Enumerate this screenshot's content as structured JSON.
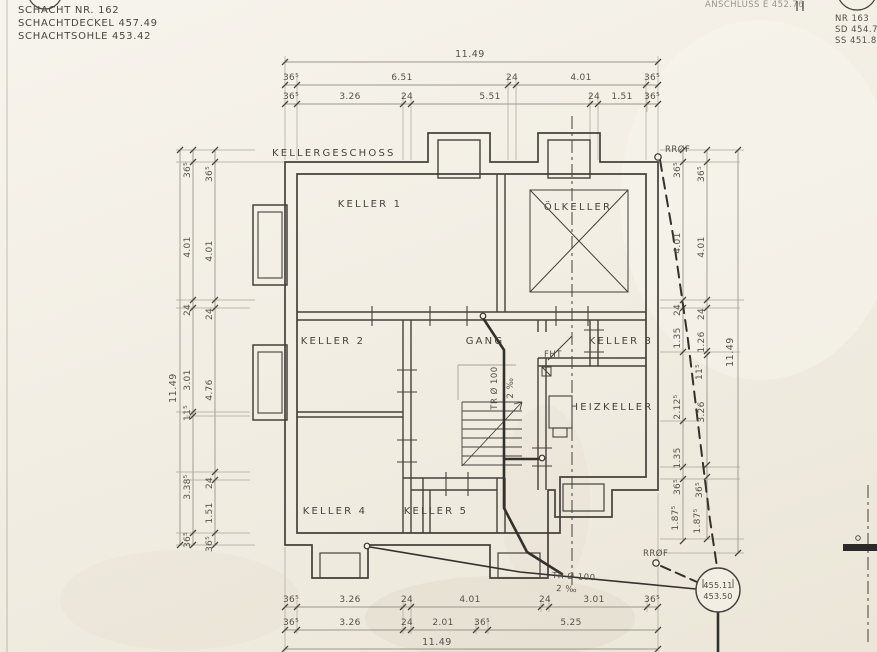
{
  "blocks": {
    "left": {
      "l1": "SCHACHT NR. 162",
      "l2": "SCHACHTDECKEL 457.49",
      "l3": "SCHACHTSOHLE 453.42"
    },
    "right": {
      "anschluss": "ANSCHLUSS E 452.76",
      "nr": "NR 163",
      "sd": "SD 454.76",
      "ss": "SS 451.87"
    }
  },
  "plan": {
    "title": "KELLERGESCHOSS",
    "rooms": {
      "k1": "KELLER 1",
      "oel": "ÖLKELLER",
      "k2": "KELLER 2",
      "gang": "GANG",
      "k3": "KELLER 3",
      "fht": "FHT",
      "heiz": "HEIZKELLER",
      "k4": "KELLER 4",
      "k5": "KELLER 5"
    }
  },
  "pipes": {
    "rrof_top": "RRØF",
    "rrof_bottom": "RRØF",
    "tr": "TR Ø 100",
    "slope": "2 ‰",
    "tr_stair": "TR Ø 100",
    "slope_stair": "2 ‰"
  },
  "manhole": {
    "cover": "455.11",
    "invert": "453.50"
  },
  "dims": {
    "top_total": "11.49",
    "top_r2": [
      "36⁵",
      "6.51",
      "24",
      "4.01",
      "36⁵"
    ],
    "top_r3": [
      "36⁵",
      "3.26",
      "24",
      "5.51",
      "24",
      "1.51",
      "36⁵"
    ],
    "bot_r1": [
      "36⁵",
      "3.26",
      "24",
      "4.01",
      "24",
      "3.01",
      "36⁵"
    ],
    "bot_r2": [
      "36⁵",
      "3.26",
      "24",
      "2.01",
      "36⁵",
      "5.25"
    ],
    "bot_total": "11.49",
    "left_total": "11.49",
    "left_mid": [
      "36⁵",
      "4.01",
      "24",
      "3.01",
      "11⁵",
      "3.38⁵",
      "36⁵"
    ],
    "left_inner": [
      "36⁵",
      "4.01",
      "24",
      "4.76",
      "24",
      "1.51",
      "36⁵"
    ],
    "right_inner": [
      "36⁵",
      "4.01",
      "24",
      "1.35",
      "2.12⁵",
      "1.35",
      "36⁵",
      "1.87⁵"
    ],
    "right_outer": [
      "36⁵",
      "4.01",
      "24",
      "1.26",
      "11⁵",
      "3.26",
      "36⁵",
      "1.87⁵"
    ],
    "right_total": "11.49"
  },
  "colors": {
    "paper": "#f2eee4",
    "ink": "#44413b",
    "dim": "#8f8b80"
  }
}
